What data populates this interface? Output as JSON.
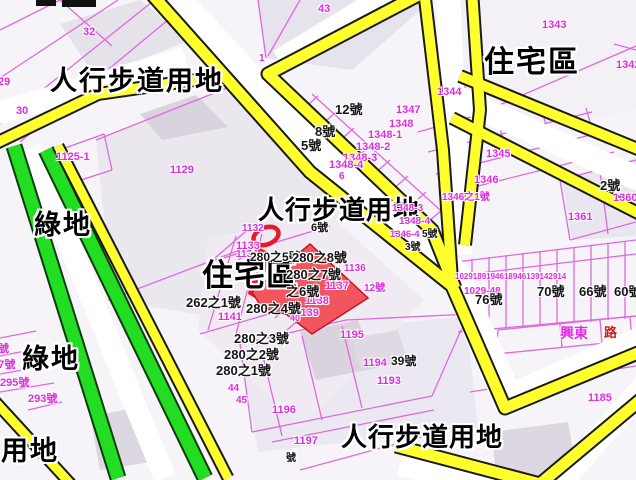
{
  "map_type": "cadastral-zoning-map",
  "colors": {
    "road_land_yellow": "#ffff2e",
    "green_land": "#22dd22",
    "parcel_line_pink": "#dd6add",
    "lot_number_magenta": "#e02ce0",
    "highlight_red": "#f2555e",
    "background": "#f7f4f9"
  },
  "marker": {
    "type": "red-selection-ring-over-highlighted-parcel"
  },
  "zones": {
    "z1": "人行步道用地",
    "z2": "人行步道用地",
    "z3": "人行步道用地",
    "z4": "住宅區",
    "z5": "住宅區",
    "z6": "綠地",
    "z7": "綠地",
    "z8": "道用地"
  },
  "mg": {
    "m1": "32",
    "m2": "29",
    "m3": "30",
    "m4": "43",
    "m5": "1",
    "m6": "1343",
    "m7": "1344",
    "m8": "1342",
    "m9": "1345",
    "m10": "1346",
    "m11": "1346之1號",
    "m12": "1347",
    "m13": "1348",
    "m14": "1348-1",
    "m15": "1348-2",
    "m16": "1348-3",
    "m17": "1348-4",
    "m18": "6",
    "m19": "1348-3",
    "m20": "1348-4",
    "m21": "1346-4",
    "m22": "1360",
    "m23": "1361",
    "m24": "1029-48",
    "m25": "1029189194618946139142914",
    "m26": "1185",
    "m27": "興東",
    "m28": "1125-1",
    "m29": "1129",
    "m30": "1133",
    "m31": "1134",
    "m32": "1132",
    "m33": "1136",
    "m34": "1137",
    "m35": "1138",
    "m36": "1139",
    "m37": "12號",
    "m38": "40",
    "m39": "1141",
    "m40": "44",
    "m41": "45",
    "m42": "1195",
    "m43": "1194",
    "m44": "1193",
    "m45": "1196",
    "m46": "1197",
    "m47": "297號",
    "m48": "295號",
    "m49": "293號",
    "m50": "號"
  },
  "hn": {
    "b1": "12號",
    "b2": "8號",
    "b3": "5號",
    "b4": "2號",
    "b5": "280之5號",
    "b6": "6號",
    "b7": "280之8號",
    "b8": "280之7號",
    "b9": "之6號",
    "b10": "262之1號",
    "b11": "280之4號",
    "b12": "280之3號",
    "b13": "280之2號",
    "b14": "280之1號",
    "b15": "76號",
    "b16": "70號",
    "b17": "66號",
    "b18": "60號",
    "b19": "39號",
    "b20": "5號",
    "b21": "3號",
    "b22": "號"
  },
  "rd": {
    "r1": "路"
  }
}
